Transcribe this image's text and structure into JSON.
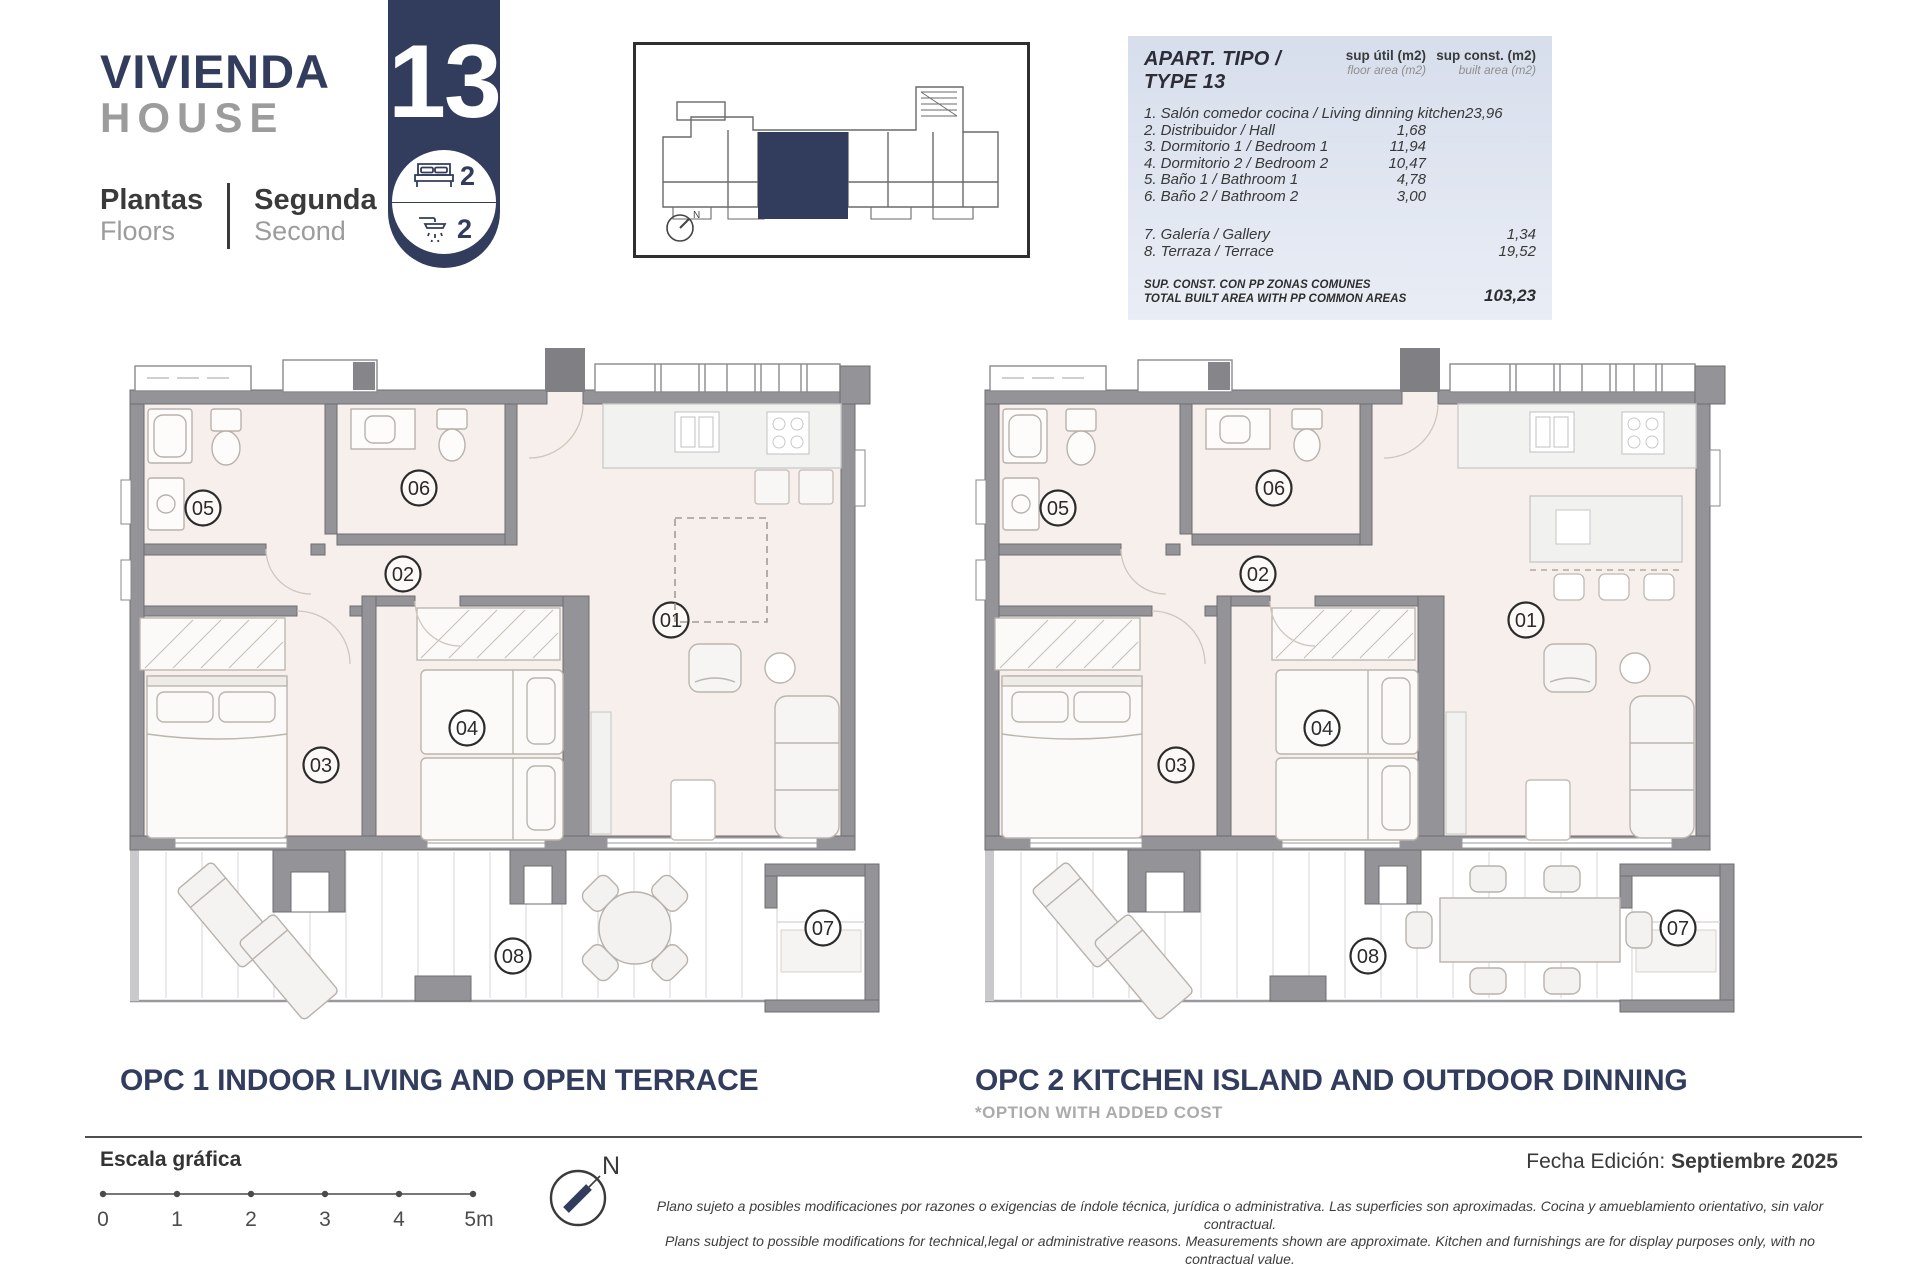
{
  "header": {
    "title_es": "VIVIENDA",
    "title_en": "HOUSE",
    "floors_label_es": "Plantas",
    "floors_label_en": "Floors",
    "floor_value_es": "Segunda",
    "floor_value_en": "Second",
    "unit_number": "13",
    "bedrooms": "2",
    "bathrooms": "2"
  },
  "area_table": {
    "title": "APART. TIPO / TYPE 13",
    "col1_label": "sup útil (m2)",
    "col1_sublabel": "floor area (m2)",
    "col2_label": "sup const. (m2)",
    "col2_sublabel": "built area (m2)",
    "rows": [
      {
        "label": "1. Salón comedor cocina / Living dinning kitchen",
        "floor_area": "23,96",
        "built_area": ""
      },
      {
        "label": "2. Distribuidor / Hall",
        "floor_area": "1,68",
        "built_area": ""
      },
      {
        "label": "3. Dormitorio 1 / Bedroom 1",
        "floor_area": "11,94",
        "built_area": ""
      },
      {
        "label": "4. Dormitorio 2 / Bedroom 2",
        "floor_area": "10,47",
        "built_area": ""
      },
      {
        "label": "5. Baño 1 / Bathroom 1",
        "floor_area": "4,78",
        "built_area": ""
      },
      {
        "label": "6. Baño 2 / Bathroom 2",
        "floor_area": "3,00",
        "built_area": ""
      },
      {
        "label": "7. Galería / Gallery",
        "floor_area": "",
        "built_area": "1,34"
      },
      {
        "label": "8. Terraza / Terrace",
        "floor_area": "",
        "built_area": "19,52"
      }
    ],
    "total_label_es": "SUP. CONST. CON PP ZONAS COMUNES",
    "total_label_en": "TOTAL BUILT AREA WITH PP COMMON AREAS",
    "total_value": "103,23"
  },
  "rooms": {
    "n1": "01",
    "n2": "02",
    "n3": "03",
    "n4": "04",
    "n5": "05",
    "n6": "06",
    "n7": "07",
    "n8": "08"
  },
  "options": {
    "opc1_title": "OPC 1 INDOOR LIVING AND OPEN TERRACE",
    "opc2_title": "OPC 2 KITCHEN ISLAND AND OUTDOOR DINNING",
    "opc2_subtitle": "*OPTION WITH ADDED COST"
  },
  "footer": {
    "scale_label": "Escala gráfica",
    "scale_ticks": [
      "0",
      "1",
      "2",
      "3",
      "4",
      "5m"
    ],
    "north_label": "N",
    "edition_label": "Fecha Edición:",
    "edition_value": "Septiembre 2025",
    "disclaimer_es": "Plano sujeto a posibles modificaciones por razones o exigencias de índole técnica,  jurídica o administrativa. Las superficies son aproximadas. Cocina y amueblamiento orientativo, sin valor contractual.",
    "disclaimer_en": "Plans subject to possible modifications for technical,legal or administrative reasons. Measurements shown are approximate. Kitchen and furnishings are for display purposes only, with no contractual value."
  },
  "colors": {
    "accent_navy": "#323c5d",
    "floor_pink": "#f7efeb",
    "wall_gray": "#939398",
    "table_bg": "#dde4f0"
  }
}
